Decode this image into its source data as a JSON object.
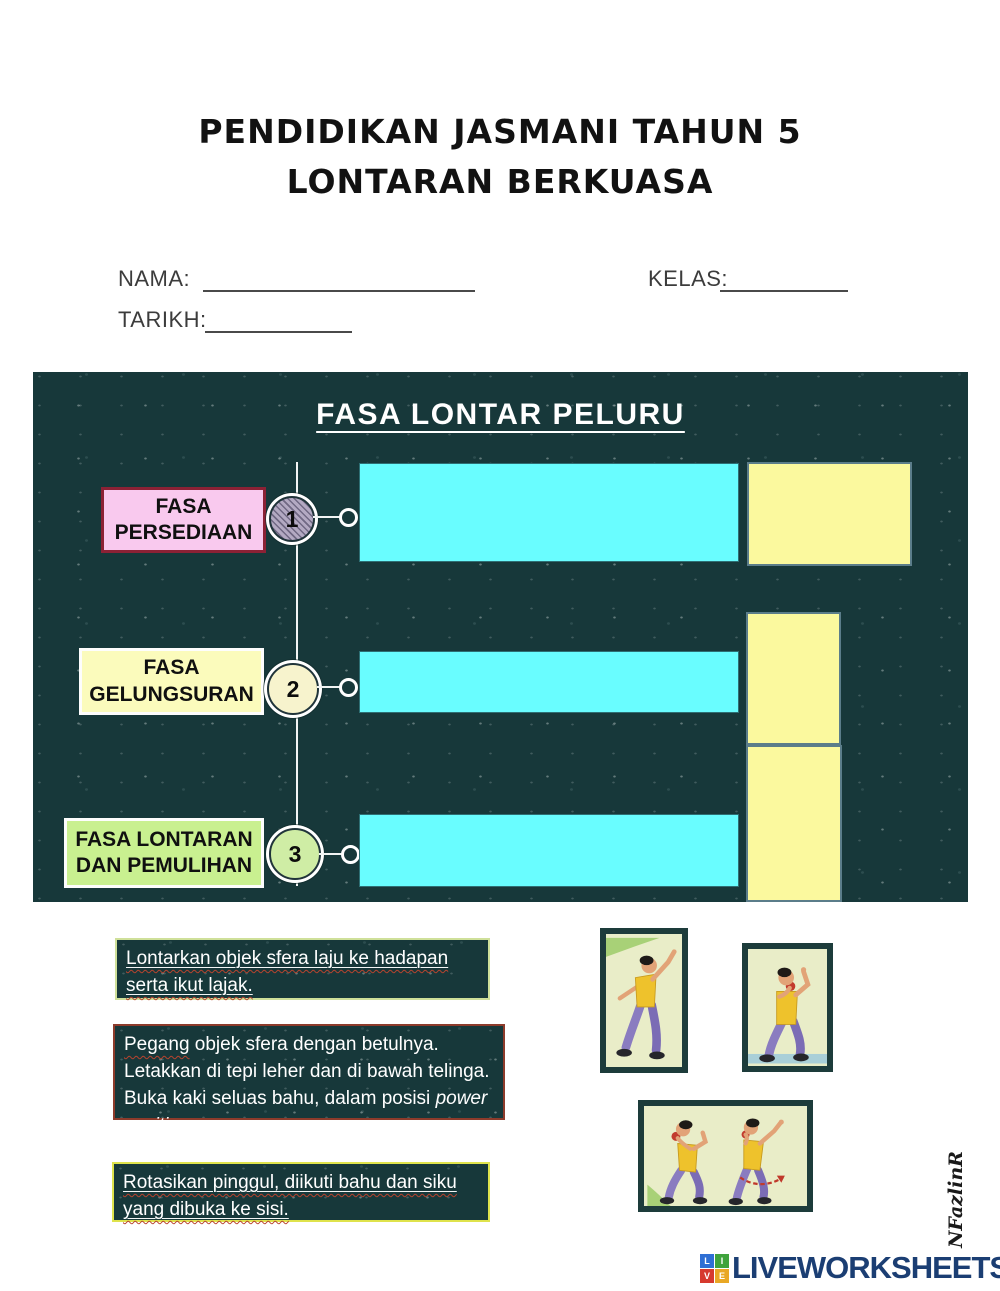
{
  "header": {
    "title_line1": "PENDIDIKAN JASMANI TAHUN 5",
    "title_line2": "LONTARAN BERKUASA"
  },
  "form": {
    "nama_label": "NAMA:",
    "kelas_label": "KELAS:",
    "tarikh_label": "TARIKH:"
  },
  "panel": {
    "title": "FASA LONTAR PELURU",
    "rows": [
      {
        "number": "1",
        "label_line1": "FASA",
        "label_line2": "PERSEDIAAN"
      },
      {
        "number": "2",
        "label_line1": "FASA",
        "label_line2": "GELUNGSURAN"
      },
      {
        "number": "3",
        "label_line1": "FASA LONTARAN",
        "label_line2": "DAN PEMULIHAN"
      }
    ]
  },
  "answer_cards": [
    {
      "text": "Lontarkan objek sfera laju ke hadapan serta ikut lajak."
    },
    {
      "lead_word": "Pegang",
      "text": " objek sfera dengan betulnya. Letakkan di tepi leher dan di bawah telinga. Buka kaki seluas bahu, dalam posisi ",
      "italic_text": "power position."
    },
    {
      "text": "Rotasikan pinggul, diikuti bahu dan siku yang dibuka ke sisi."
    }
  ],
  "figures": [
    {
      "name": "shot-put-follow-through-illustration"
    },
    {
      "name": "shot-put-hold-at-neck-illustration"
    },
    {
      "name": "shot-put-power-position-rotation-illustration"
    }
  ],
  "footer": {
    "logo_blocks": [
      {
        "letter": "L",
        "color": "#2f6fd4"
      },
      {
        "letter": "I",
        "color": "#3fa33c"
      },
      {
        "letter": "V",
        "color": "#d63a2f"
      },
      {
        "letter": "E",
        "color": "#e9a825"
      }
    ],
    "logo_text": "LIVEWORKSHEETS",
    "signature": "NFazlinR"
  },
  "colors": {
    "panel_bg": "#17383a",
    "cyan_answer_box": "#69fdff",
    "yellow_answer_box": "#fbf99e",
    "pink_label_bg": "#f9c9ee",
    "pink_label_border": "#8c2135",
    "yellow_label_bg": "#fbfbbc",
    "green_label_bg": "#c9f090",
    "logo_text_blue": "#1b3e73",
    "spellcheck_wavy": "#b8432e"
  }
}
